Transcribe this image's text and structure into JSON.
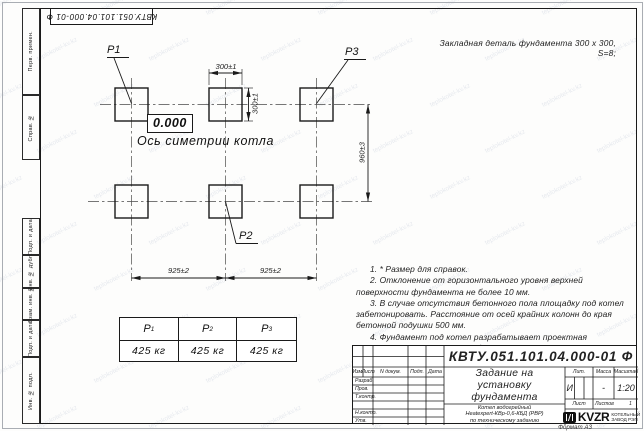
{
  "page": {
    "watermark_text": "teplokotel-kv.kz",
    "format_label": "Формат А3"
  },
  "margin_labels": {
    "top_designation": "КВТУ.051.101.04.000-01  Ф",
    "perv_primen": "Перв. примен.",
    "sprav_n": "Справ. №",
    "podp_data_1": "Подп. и дата",
    "inv_dubl": "Инв. № дубл.",
    "vzam_inv": "Взам. инв. №",
    "podp_data_2": "Подп. и дата",
    "inv_podl": "Инв. № подл."
  },
  "annotation": "Закладная деталь фундамента  300 х 300,  S=8;",
  "drawing": {
    "point_labels": {
      "p1": "P1",
      "p2": "P2",
      "p3": "P3"
    },
    "elevation": "0.000",
    "axis_label": "Ось симетрии котла",
    "dims": {
      "w300": "300±1",
      "h300": "300±1",
      "v960": "960±3",
      "l925": "925±2",
      "r925": "925±2"
    }
  },
  "load_table": {
    "headers": [
      {
        "p": "P",
        "sub": "1"
      },
      {
        "p": "P",
        "sub": "2"
      },
      {
        "p": "P",
        "sub": "3"
      }
    ],
    "values": [
      "425 кг",
      "425 кг",
      "425 кг"
    ]
  },
  "notes": [
    "1. * Размер для справок.",
    "2. Отклонение от горизонтального уровня верхней поверхности фундамента не более 10 мм.",
    "3. В случае отсутствия бетонного пола площадку под котел забетонировать. Расстояние от осей крайних колонн до края бетонной подушки 500 мм.",
    "4. Фундамент под котел разрабатывает проектная организация по нагрузкам на фундамент."
  ],
  "title_block": {
    "designation": "КВТУ.051.101.04.000-01  Ф",
    "header_cols": [
      "Изм.",
      "Лист",
      "N докум.",
      "Подп.",
      "Дата"
    ],
    "sign_rows": [
      "Разраб.",
      "Пров.",
      "Т.контр.",
      "",
      "Н.контр.",
      "Утв."
    ],
    "doc_title_lines": [
      "Задание на",
      "установку",
      "фундамента"
    ],
    "product_lines": [
      "Котел водогрейный",
      "Heatexpert-КВр-0,6-КБД (РВР)",
      "по техническому заданию"
    ],
    "lit": {
      "label": "Лит.",
      "value": "И"
    },
    "mass": {
      "label": "Масса",
      "value": "-"
    },
    "scale": {
      "label": "Масштаб",
      "value": "1:20"
    },
    "sheet": {
      "label": "Лист",
      "of_label": "Листов",
      "of_value": "1"
    },
    "company": {
      "logo_text": "KVZR",
      "name_line1": "КОТЕЛЬНЫЙ",
      "name_line2": "ЗАВОД РЭП"
    }
  }
}
